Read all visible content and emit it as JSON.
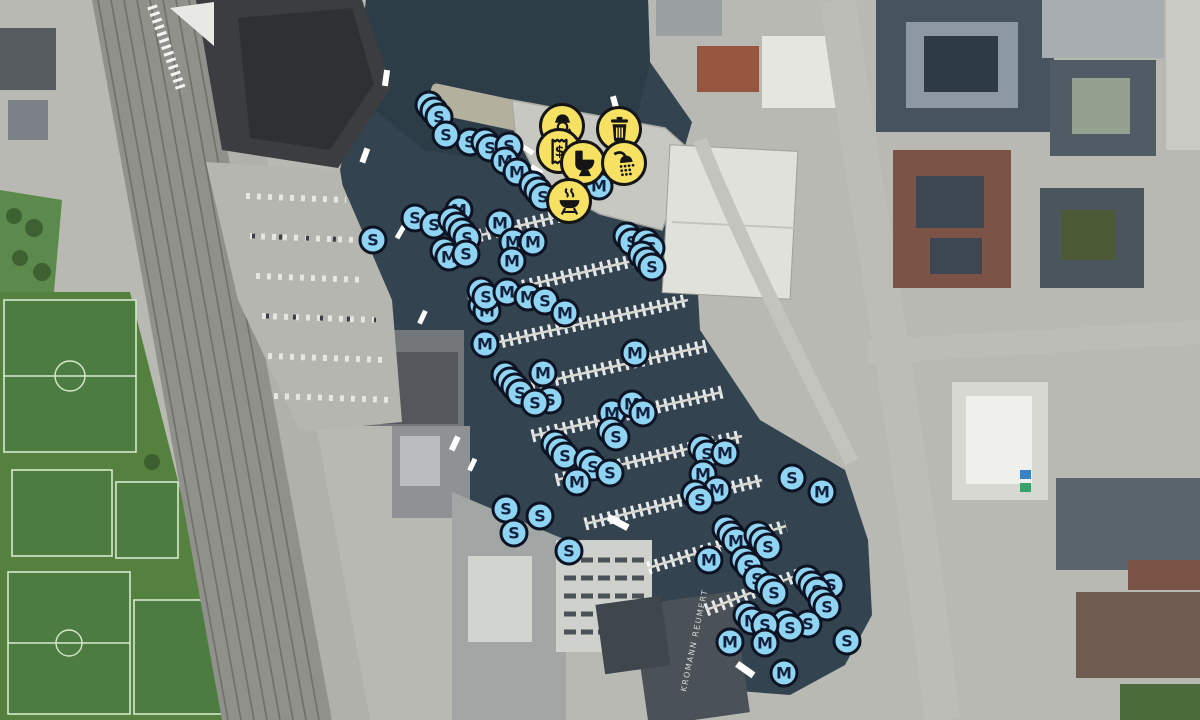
{
  "map": {
    "type": "marina-aerial-map",
    "building_label": "KROMANN REUMERT",
    "marker_letters": [
      "S",
      "M"
    ],
    "colors": {
      "marker_fill": "#8fd4f2",
      "marker_ring": "#0d1322",
      "marker_letter": "#13213d",
      "amenity_fill": "#f7e163",
      "amenity_ring": "#151515",
      "water": "#334450"
    },
    "amenities": [
      {
        "name": "harbour-master",
        "x": 562,
        "y": 126
      },
      {
        "name": "waste-disposal",
        "x": 619,
        "y": 129
      },
      {
        "name": "payment",
        "x": 559,
        "y": 151
      },
      {
        "name": "toilet",
        "x": 583,
        "y": 163
      },
      {
        "name": "shower",
        "x": 624,
        "y": 163
      },
      {
        "name": "bbq",
        "x": 569,
        "y": 201
      }
    ],
    "markers": [
      {
        "l": "S",
        "x": 439,
        "y": 117,
        "s": 2
      },
      {
        "l": "S",
        "x": 470,
        "y": 142,
        "s": 0
      },
      {
        "l": "S",
        "x": 490,
        "y": 148,
        "s": 1
      },
      {
        "l": "S",
        "x": 509,
        "y": 146,
        "s": 0
      },
      {
        "l": "S",
        "x": 446,
        "y": 135,
        "s": 0
      },
      {
        "l": "M",
        "x": 505,
        "y": 161,
        "s": 0
      },
      {
        "l": "M",
        "x": 517,
        "y": 172,
        "s": 0
      },
      {
        "l": "S",
        "x": 543,
        "y": 197,
        "s": 2
      },
      {
        "l": "M",
        "x": 599,
        "y": 186,
        "s": 0
      },
      {
        "l": "S",
        "x": 373,
        "y": 240,
        "s": 0
      },
      {
        "l": "S",
        "x": 415,
        "y": 218,
        "s": 0
      },
      {
        "l": "S",
        "x": 434,
        "y": 225,
        "s": 0
      },
      {
        "l": "M",
        "x": 459,
        "y": 210,
        "s": 0
      },
      {
        "l": "M",
        "x": 500,
        "y": 223,
        "s": 0
      },
      {
        "l": "M",
        "x": 513,
        "y": 242,
        "s": 0
      },
      {
        "l": "M",
        "x": 533,
        "y": 242,
        "s": 0
      },
      {
        "l": "M",
        "x": 512,
        "y": 261,
        "s": 0
      },
      {
        "l": "M",
        "x": 449,
        "y": 257,
        "s": 1
      },
      {
        "l": "S",
        "x": 467,
        "y": 238,
        "s": 3
      },
      {
        "l": "S",
        "x": 466,
        "y": 254,
        "s": 0
      },
      {
        "l": "S",
        "x": 632,
        "y": 242,
        "s": 1
      },
      {
        "l": "S",
        "x": 651,
        "y": 248,
        "s": 1
      },
      {
        "l": "S",
        "x": 652,
        "y": 267,
        "s": 2
      },
      {
        "l": "M",
        "x": 487,
        "y": 311,
        "s": 1
      },
      {
        "l": "S",
        "x": 486,
        "y": 297,
        "s": 1
      },
      {
        "l": "M",
        "x": 507,
        "y": 292,
        "s": 0
      },
      {
        "l": "M",
        "x": 528,
        "y": 297,
        "s": 0
      },
      {
        "l": "S",
        "x": 545,
        "y": 301,
        "s": 0
      },
      {
        "l": "M",
        "x": 565,
        "y": 313,
        "s": 0
      },
      {
        "l": "M",
        "x": 485,
        "y": 344,
        "s": 0
      },
      {
        "l": "M",
        "x": 543,
        "y": 373,
        "s": 0
      },
      {
        "l": "M",
        "x": 635,
        "y": 353,
        "s": 0
      },
      {
        "l": "S",
        "x": 520,
        "y": 393,
        "s": 3
      },
      {
        "l": "S",
        "x": 550,
        "y": 400,
        "s": 0
      },
      {
        "l": "S",
        "x": 535,
        "y": 403,
        "s": 0
      },
      {
        "l": "M",
        "x": 612,
        "y": 413,
        "s": 0
      },
      {
        "l": "M",
        "x": 632,
        "y": 404,
        "s": 0
      },
      {
        "l": "M",
        "x": 643,
        "y": 413,
        "s": 0
      },
      {
        "l": "S",
        "x": 616,
        "y": 437,
        "s": 1
      },
      {
        "l": "S",
        "x": 565,
        "y": 456,
        "s": 2
      },
      {
        "l": "S",
        "x": 593,
        "y": 467,
        "s": 1
      },
      {
        "l": "S",
        "x": 610,
        "y": 473,
        "s": 0
      },
      {
        "l": "M",
        "x": 577,
        "y": 482,
        "s": 0
      },
      {
        "l": "S",
        "x": 506,
        "y": 509,
        "s": 0
      },
      {
        "l": "S",
        "x": 540,
        "y": 516,
        "s": 0
      },
      {
        "l": "S",
        "x": 514,
        "y": 533,
        "s": 0
      },
      {
        "l": "S",
        "x": 569,
        "y": 551,
        "s": 0
      },
      {
        "l": "S",
        "x": 707,
        "y": 454,
        "s": 1
      },
      {
        "l": "M",
        "x": 725,
        "y": 453,
        "s": 0
      },
      {
        "l": "M",
        "x": 703,
        "y": 474,
        "s": 0
      },
      {
        "l": "M",
        "x": 717,
        "y": 490,
        "s": 0
      },
      {
        "l": "S",
        "x": 700,
        "y": 500,
        "s": 1
      },
      {
        "l": "S",
        "x": 792,
        "y": 478,
        "s": 0
      },
      {
        "l": "M",
        "x": 822,
        "y": 492,
        "s": 0
      },
      {
        "l": "M",
        "x": 736,
        "y": 541,
        "s": 2
      },
      {
        "l": "S",
        "x": 768,
        "y": 547,
        "s": 2
      },
      {
        "l": "M",
        "x": 709,
        "y": 560,
        "s": 0
      },
      {
        "l": "S",
        "x": 749,
        "y": 566,
        "s": 1
      },
      {
        "l": "S",
        "x": 757,
        "y": 579,
        "s": 0
      },
      {
        "l": "S",
        "x": 774,
        "y": 593,
        "s": 1
      },
      {
        "l": "S",
        "x": 831,
        "y": 585,
        "s": 0
      },
      {
        "l": "S",
        "x": 817,
        "y": 591,
        "s": 2
      },
      {
        "l": "S",
        "x": 827,
        "y": 607,
        "s": 1
      },
      {
        "l": "S",
        "x": 808,
        "y": 624,
        "s": 0
      },
      {
        "l": "S",
        "x": 790,
        "y": 628,
        "s": 1
      },
      {
        "l": "M",
        "x": 752,
        "y": 621,
        "s": 1
      },
      {
        "l": "S",
        "x": 765,
        "y": 625,
        "s": 0
      },
      {
        "l": "M",
        "x": 730,
        "y": 642,
        "s": 0
      },
      {
        "l": "M",
        "x": 765,
        "y": 643,
        "s": 0
      },
      {
        "l": "S",
        "x": 847,
        "y": 641,
        "s": 0
      },
      {
        "l": "M",
        "x": 784,
        "y": 673,
        "s": 0
      }
    ]
  }
}
